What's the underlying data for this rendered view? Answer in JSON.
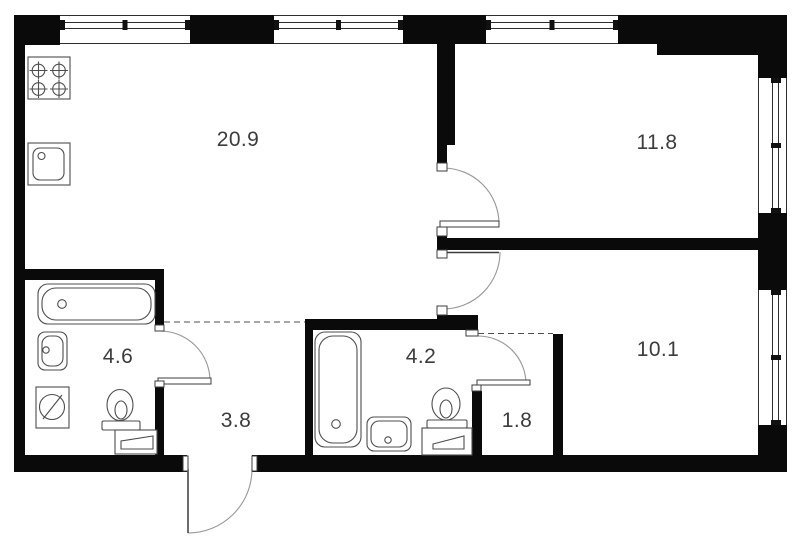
{
  "plan": {
    "width": 800,
    "height": 537,
    "colors": {
      "background": "#ffffff",
      "wall": "#0a0a0a",
      "window_line": "#2e2e2e",
      "fixture_line": "#4d4d4d",
      "arc": "#979797",
      "leaf_line": "#3c3c3c",
      "dash": "#4d4d4d",
      "text": "#3c3c3c",
      "tick": "#111111"
    },
    "rooms": [
      {
        "name": "kitchen-living",
        "area": "20.9",
        "x": 238,
        "y": 140
      },
      {
        "name": "bedroom",
        "area": "11.8",
        "x": 657,
        "y": 143
      },
      {
        "name": "room",
        "area": "10.1",
        "x": 658,
        "y": 350
      },
      {
        "name": "bathroom",
        "area": "4.6",
        "x": 118,
        "y": 357
      },
      {
        "name": "bathroom-2",
        "area": "4.2",
        "x": 421,
        "y": 357
      },
      {
        "name": "hallway",
        "area": "3.8",
        "x": 236,
        "y": 421
      },
      {
        "name": "wardrobe",
        "area": "1.8",
        "x": 517,
        "y": 421
      }
    ],
    "walls": [
      [
        14,
        15,
        11,
        457
      ],
      [
        14,
        15,
        46,
        30
      ],
      [
        190,
        15,
        84,
        29
      ],
      [
        403,
        15,
        83,
        29
      ],
      [
        618,
        15,
        39,
        29
      ],
      [
        657,
        15,
        130,
        40
      ],
      [
        758,
        55,
        29,
        23
      ],
      [
        758,
        213,
        29,
        77
      ],
      [
        758,
        425,
        29,
        47
      ],
      [
        14,
        455,
        173,
        17
      ],
      [
        252,
        455,
        535,
        17
      ],
      [
        437,
        44,
        18,
        101
      ],
      [
        437,
        145,
        10,
        18
      ],
      [
        437,
        236,
        10,
        14
      ],
      [
        437,
        238,
        321,
        12
      ],
      [
        437,
        315,
        41,
        15
      ],
      [
        305,
        319,
        173,
        11
      ],
      [
        305,
        330,
        8,
        125
      ],
      [
        472,
        391,
        10,
        64
      ],
      [
        553,
        334,
        10,
        121
      ],
      [
        25,
        269,
        139,
        11
      ],
      [
        155,
        280,
        9,
        45
      ],
      [
        155,
        387,
        9,
        68
      ]
    ],
    "windows": [
      {
        "orient": "h",
        "x": 60,
        "y": 15,
        "w": 130,
        "h": 29
      },
      {
        "orient": "h",
        "x": 274,
        "y": 15,
        "w": 129,
        "h": 29
      },
      {
        "orient": "h",
        "x": 486,
        "y": 15,
        "w": 132,
        "h": 29
      },
      {
        "orient": "v",
        "x": 758,
        "y": 78,
        "w": 29,
        "h": 135
      },
      {
        "orient": "v",
        "x": 758,
        "y": 290,
        "w": 29,
        "h": 135
      }
    ],
    "doors": [
      {
        "name": "door-bedroom",
        "arc": "M 499 224 A 56 56 0 0 0 443 168",
        "leaf_rect": [
          440,
          221,
          59,
          6
        ]
      },
      {
        "name": "door-room",
        "arc": "M 500 252 A 57 57 0 0 1 443 309",
        "leaf_line": [
          443,
          252.5,
          499,
          252.5
        ]
      },
      {
        "name": "door-bathroom",
        "arc": "M 160 331 A 50 50 0 0 1 210 381",
        "leaf_rect": [
          158,
          378,
          53,
          6
        ]
      },
      {
        "name": "door-wardrobe",
        "arc": "M 478 336 A 48 48 0 0 1 526 384",
        "leaf_rect": [
          477,
          380,
          53,
          5
        ]
      },
      {
        "name": "door-entrance",
        "arc": "M 252 469 A 64 64 0 0 1 188 533",
        "leaf_line": [
          188,
          469,
          188,
          533
        ]
      }
    ],
    "jambs": [
      [
        437,
        163,
        10,
        8
      ],
      [
        437,
        227,
        10,
        9
      ],
      [
        437,
        250,
        10,
        8
      ],
      [
        437,
        306,
        10,
        9
      ],
      [
        155,
        325,
        9,
        6
      ],
      [
        155,
        381,
        9,
        6
      ],
      [
        466,
        330,
        12,
        6
      ],
      [
        472,
        385,
        9,
        6
      ],
      [
        183,
        456,
        5,
        15
      ],
      [
        252,
        456,
        5,
        15
      ]
    ],
    "dashed_lines": [
      [
        164,
        322,
        305,
        322
      ],
      [
        478,
        333.5,
        553,
        333.5
      ]
    ],
    "fixtures": [
      {
        "type": "stove",
        "name": "stove",
        "x": 28,
        "y": 57,
        "w": 42,
        "h": 42,
        "burner_r": 6.3,
        "burners": [
          [
            38.5,
            70.5
          ],
          [
            59,
            70.5
          ],
          [
            38.5,
            89
          ],
          [
            59,
            89
          ]
        ]
      },
      {
        "type": "sink-sq",
        "name": "kitchen-sink",
        "x": 28,
        "y": 143,
        "w": 42,
        "h": 42,
        "inner": [
          33,
          148,
          31,
          32,
          7
        ],
        "dot": [
          41.5,
          156,
          3.5
        ]
      },
      {
        "type": "tub",
        "name": "bathtub",
        "x": 38,
        "y": 284,
        "w": 117,
        "h": 40,
        "dot": [
          62,
          304,
          4.3
        ]
      },
      {
        "type": "basin",
        "name": "washbasin",
        "x": 38,
        "y": 332,
        "w": 29,
        "h": 38,
        "dot": [
          46,
          350,
          3.2
        ]
      },
      {
        "type": "washer",
        "name": "washing-machine",
        "x": 36,
        "y": 387,
        "w": 33,
        "h": 41,
        "circle": [
          52,
          407,
          12.5
        ],
        "slash": [
          43,
          419,
          62,
          395
        ]
      },
      {
        "type": "toilet",
        "name": "toilet",
        "cistern": [
          102,
          421,
          38,
          9
        ],
        "bowl": [
          120,
          405,
          13,
          15.5
        ],
        "inner_bowl": [
          121,
          410,
          6,
          9
        ]
      },
      {
        "type": "cabinet",
        "name": "cabinet",
        "x": 115,
        "y": 430,
        "w": 42,
        "h": 24,
        "drawer": [
          [
            121,
            449
          ],
          [
            121,
            441
          ],
          [
            153,
            436
          ],
          [
            153,
            449
          ]
        ]
      },
      {
        "type": "tub",
        "name": "bathtub-2",
        "x": 315,
        "y": 332,
        "w": 46,
        "h": 115,
        "dot": [
          336,
          424,
          4.3
        ]
      },
      {
        "type": "basin",
        "name": "washbasin-2",
        "x": 367,
        "y": 417,
        "w": 44,
        "h": 34,
        "dot": [
          388,
          440,
          3.2
        ]
      },
      {
        "type": "toilet",
        "name": "toilet-2",
        "cistern": [
          427,
          420,
          40,
          8
        ],
        "bowl": [
          446,
          404,
          14,
          16
        ],
        "inner_bowl": [
          446,
          409,
          6,
          9
        ]
      },
      {
        "type": "cabinet",
        "name": "cabinet-2",
        "x": 422,
        "y": 428,
        "w": 50,
        "h": 27,
        "drawer": [
          [
            433,
            449
          ],
          [
            433,
            444
          ],
          [
            464,
            436
          ],
          [
            464,
            449
          ]
        ]
      }
    ]
  }
}
